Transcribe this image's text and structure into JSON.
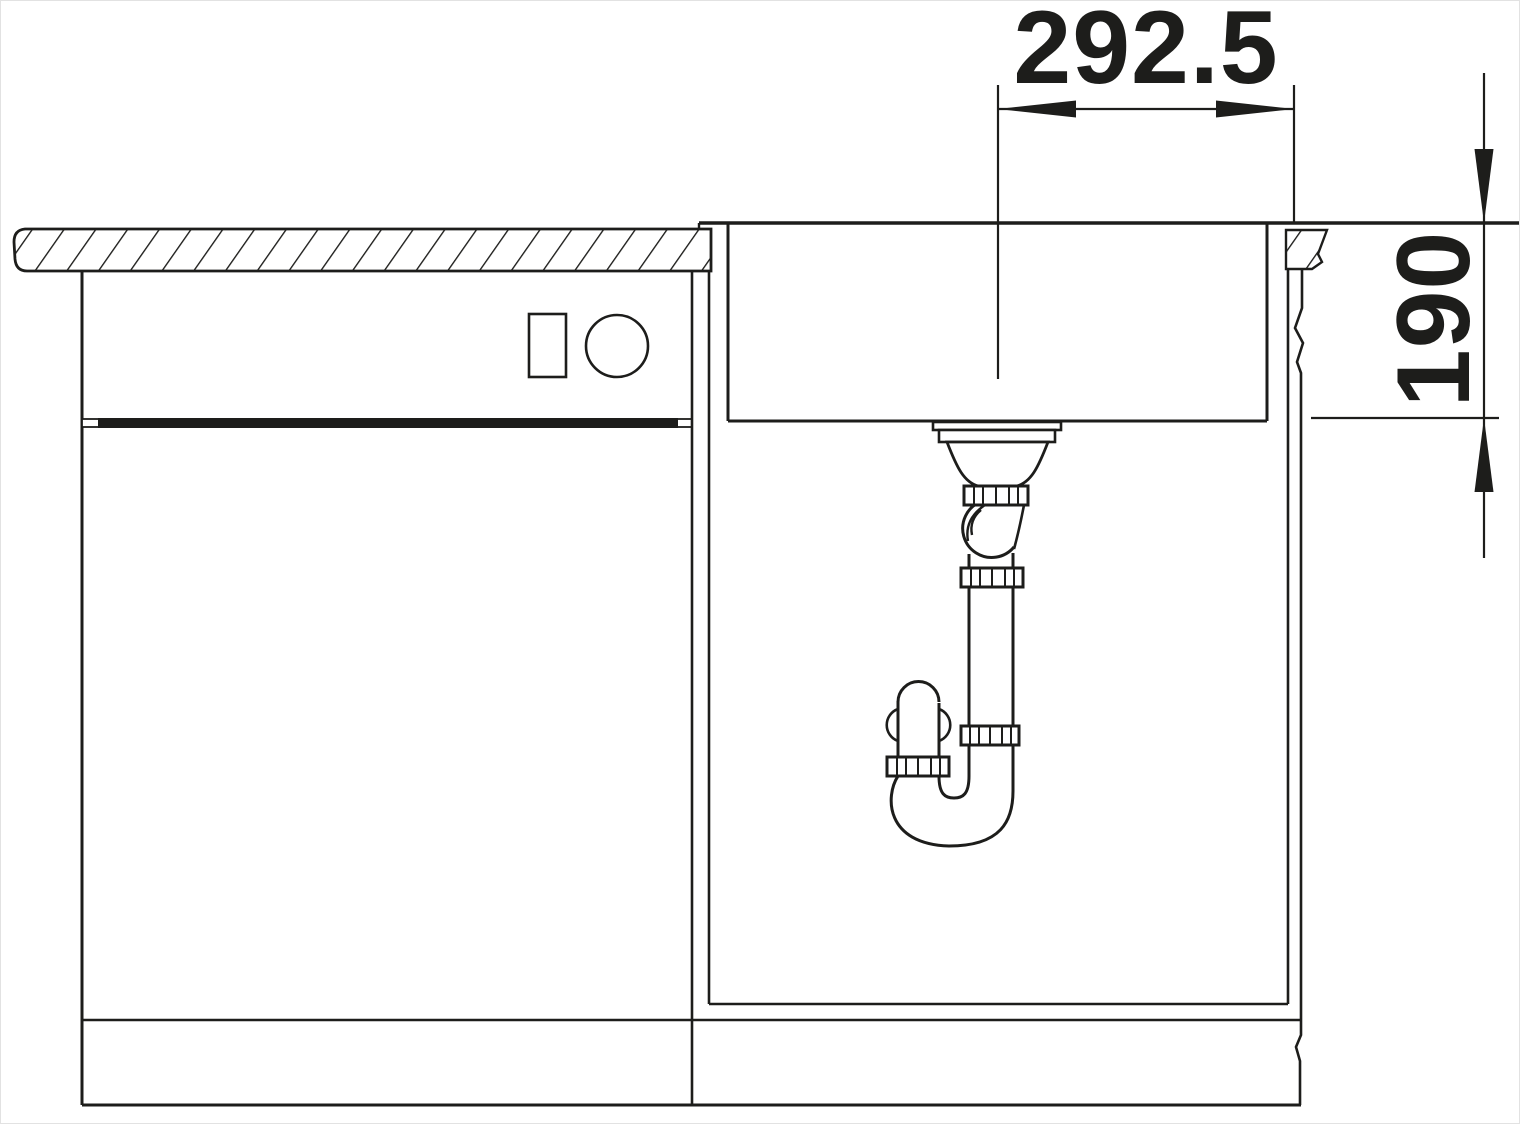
{
  "drawing": {
    "type": "sink-installation-section-view",
    "colors": {
      "line": "#1d1d1b",
      "background": "#ffffff"
    },
    "dimensions": {
      "horizontal": {
        "label": "292.5"
      },
      "vertical": {
        "label": "190"
      }
    }
  }
}
